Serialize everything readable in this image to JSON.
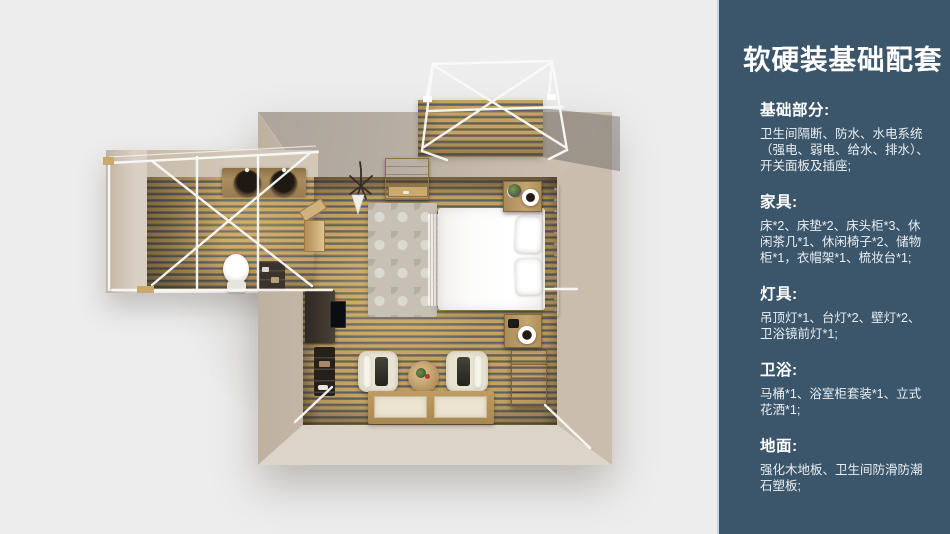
{
  "canvas": {
    "width": 950,
    "height": 534
  },
  "colors": {
    "background": "#ededed",
    "sidebar_panel": "#3b566a",
    "sidebar_edge": "#ccd4da",
    "heading_text": "#ffffff",
    "body_text": "#e9eef2",
    "wall_beige": "#cbbfae",
    "wall_shadow": "#b2a89e",
    "floor_wood": "#c3a264",
    "plank_gap": "#5d6069",
    "frame_white": "#fafaf8"
  },
  "sidebar": {
    "title": "软硬装基础配套",
    "sections": [
      {
        "heading": "基础部分:",
        "body": "卫生间隔断、防水、水电系统\n（强电、弱电、给水、排水）、\n开关面板及插座;"
      },
      {
        "heading": "家具:",
        "body": "床*2、床垫*2、床头柜*3、休\n闲茶几*1、休闲椅子*2、储物\n柜*1，衣帽架*1、梳妆台*1;"
      },
      {
        "heading": "灯具:",
        "body": "吊顶灯*1、台灯*2、壁灯*2、\n卫浴镜前灯*1;"
      },
      {
        "heading": "卫浴:",
        "body": "马桶*1、浴室柜套装*1、立式\n花洒*1;"
      },
      {
        "heading": "地面:",
        "body": "强化木地板、卫生间防滑防潮\n石塑板;"
      }
    ]
  },
  "floorplan": {
    "view": "top-down 3D render of a bedroom suite",
    "areas": [
      "bedroom",
      "bathroom-annex",
      "canopy-deck"
    ],
    "objects": [
      "double-bed",
      "pillows",
      "patterned-rug",
      "wardrobe-cabinet",
      "nightstand-with-plant-and-cup",
      "nightstand-with-cup",
      "chest-of-drawers",
      "lounge-chair",
      "lounge-chair",
      "round-tea-table",
      "tatami-floor-mats",
      "desk-with-tv",
      "ladder-shelf",
      "wall-shelf",
      "twin-basin-counter",
      "toilet",
      "bathroom-shelf",
      "hanging-planter",
      "headboard-wall-panel",
      "white-canopy-frame",
      "white-canopy-frame"
    ]
  }
}
